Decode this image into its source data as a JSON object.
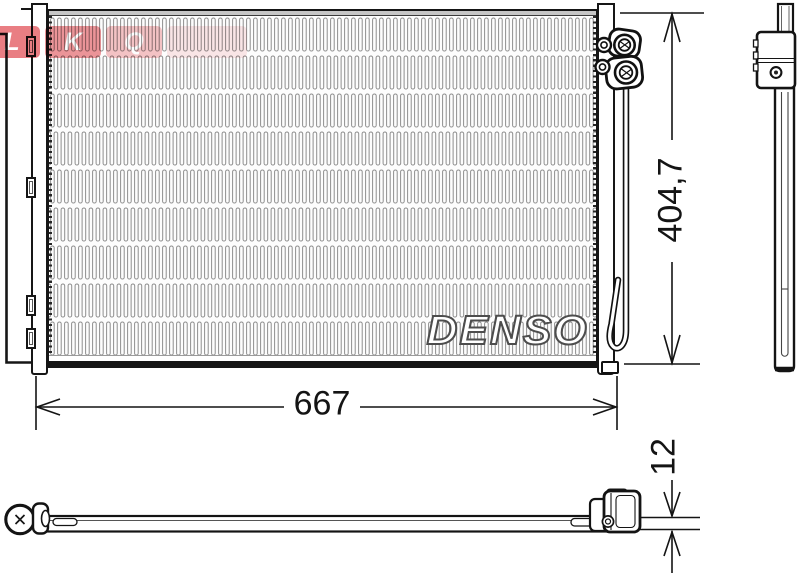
{
  "page": {
    "background": "#ffffff",
    "line_color": "#151515"
  },
  "brand": {
    "logo_text": "DENSO",
    "logo_outline_color": "#4d4d4d"
  },
  "watermark": {
    "letters": [
      "L",
      "K",
      "Q"
    ],
    "color": "#d7141e"
  },
  "dimensions": {
    "width": {
      "value": "667"
    },
    "height": {
      "value": "404,7"
    },
    "depth": {
      "value": "12"
    }
  }
}
